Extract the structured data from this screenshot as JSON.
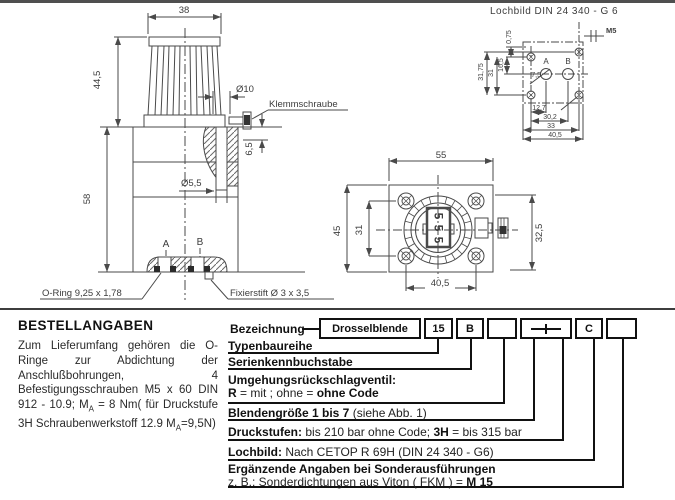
{
  "colors": {
    "line": "#4a4a4a",
    "text": "#1f1f1f",
    "box_border": "#111111",
    "background": "#ffffff"
  },
  "side_view": {
    "dim_38": "38",
    "dim_44_5": "44,5",
    "dim_58": "58",
    "dim_d10": "Ø10",
    "dim_d5_5": "Ø5,5",
    "dim_6_5": "6,5",
    "label_klemmschraube": "Klemmschraube",
    "label_a": "A",
    "label_b": "B",
    "label_oring": "O-Ring 9,25 x 1,78",
    "label_fixierstift": "Fixierstift Ø 3 x 3,5"
  },
  "front_view": {
    "dim_55": "55",
    "dim_45": "45",
    "dim_31": "31",
    "dim_32_5": "32,5",
    "dim_40_5": "40,5",
    "digits": [
      "5",
      "5",
      "5"
    ]
  },
  "lochbild": {
    "title": "Lochbild DIN 24 340 - G 6",
    "dim_m5": "M5",
    "dim_0_75": "0,75",
    "dim_16_5": "16,5",
    "dim_31": "31",
    "dim_31_75": "31,75",
    "dim_7_5": "7,5",
    "label_a": "A",
    "label_b": "B",
    "dim_12_7": "12,7",
    "dim_30_2": "30,2",
    "dim_33": "33",
    "dim_40_5": "40,5"
  },
  "bestellangaben": {
    "title": "BESTELLANGABEN",
    "body_1": "Zum Lieferumfang gehören die O-Ringe zur Abdichtung der Anschlußbohrungen, 4 Befestigungsschrauben M5 x 60 DIN 912 - 10.9; M",
    "sub_1": "A",
    "body_2": " = 8 Nm( für Druckstufe 3H Schraubenwerkstoff 12.9 M",
    "sub_2": "A",
    "body_3": "=9,5N)"
  },
  "order_code": {
    "label": "Bezeichnung",
    "box_1": "Drosselblende",
    "box_2": "15",
    "box_3": "B",
    "box_4": "",
    "box_5_symbol": "dash-tick-placeholder",
    "box_6": "C",
    "box_7": ""
  },
  "order_rows": {
    "r1": "Typenbaureihe",
    "r2": "Serienkennbuchstabe",
    "r3_l1": "Umgehungsrückschlagventil:",
    "r3_b1": "R",
    "r3_t1": " = mit ; ohne = ",
    "r3_b2": "ohne Code",
    "r4_b1": "Blendengröße 1 bis 7",
    "r4_t1": " (siehe Abb. 1)",
    "r5_b1": "Druckstufen:",
    "r5_t1": " bis 210 bar ohne Code; ",
    "r5_b2": "3H",
    "r5_t2": " = bis 315 bar",
    "r6_b1": "Lochbild:",
    "r6_t1": " Nach CETOP R 69H (DIN 24 340 - G6)",
    "r7_l1": "Ergänzende Angaben bei Sonderausführungen",
    "r7_t1": "z. B.: Sonderdichtungen aus Viton ( FKM ) = ",
    "r7_b1": "M 15"
  }
}
